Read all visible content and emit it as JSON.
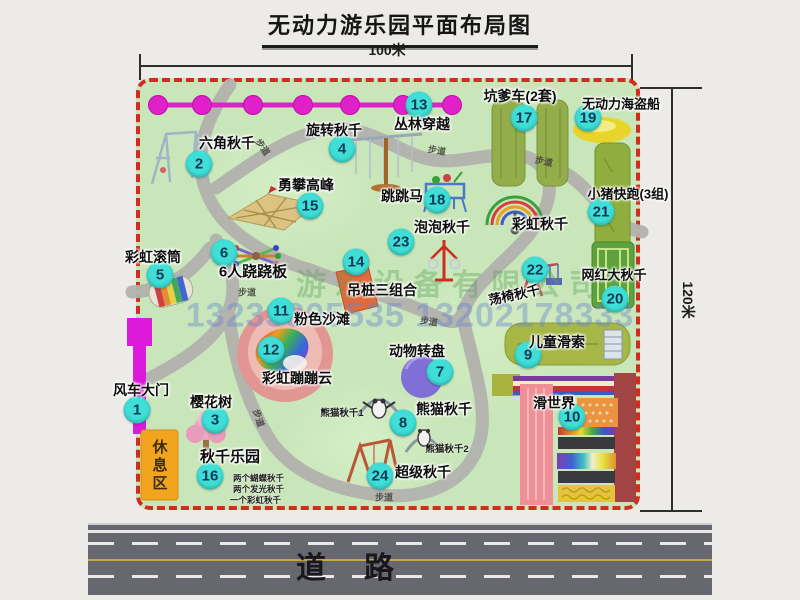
{
  "title": "无动力游乐园平面布局图",
  "dim_top_label": "100米",
  "dim_right_label": "120米",
  "road_label": "道路",
  "rest_area_label": "休息区",
  "walkway_text": "步道",
  "watermark_company": "游乐设备有限公司",
  "watermark_phone": "13233805535 13202178333",
  "colors": {
    "park_fill": "#c9e6ba",
    "boundary_red": "#d02d1e",
    "badge_cyan": "#3fded6",
    "zipline_magenta": "#e020c8",
    "road_gray": "#67676f",
    "rest_area_orange": "#f3a41f",
    "gate_magenta": "#dc1adc"
  },
  "attractions": [
    {
      "n": "1",
      "name": "风车大门",
      "bx": 137,
      "by": 410,
      "lx": 141,
      "ly": 390
    },
    {
      "n": "2",
      "name": "六角秋千",
      "bx": 199,
      "by": 164,
      "lx": 227,
      "ly": 143
    },
    {
      "n": "3",
      "name": "樱花树",
      "bx": 215,
      "by": 420,
      "lx": 211,
      "ly": 402
    },
    {
      "n": "4",
      "name": "旋转秋千",
      "bx": 342,
      "by": 149,
      "lx": 334,
      "ly": 130
    },
    {
      "n": "5",
      "name": "彩虹滚筒",
      "bx": 160,
      "by": 275,
      "lx": 153,
      "ly": 257
    },
    {
      "n": "6",
      "name": "6人跷跷板",
      "bx": 224,
      "by": 253,
      "lx": 253,
      "ly": 271,
      "fs": 15
    },
    {
      "n": "7",
      "name": "动物转盘",
      "bx": 440,
      "by": 372,
      "lx": 417,
      "ly": 351
    },
    {
      "n": "8",
      "name": "熊猫秋千",
      "bx": 403,
      "by": 423,
      "lx": 444,
      "ly": 409
    },
    {
      "n": "9",
      "name": "儿童滑索",
      "bx": 528,
      "by": 355,
      "lx": 557,
      "ly": 342
    },
    {
      "n": "10",
      "name": "滑世界",
      "bx": 572,
      "by": 417,
      "lx": 554,
      "ly": 403
    },
    {
      "n": "11",
      "name": "粉色沙滩",
      "bx": 281,
      "by": 311,
      "lx": 322,
      "ly": 319
    },
    {
      "n": "12",
      "name": "彩虹蹦蹦云",
      "bx": 271,
      "by": 350,
      "lx": 297,
      "ly": 378
    },
    {
      "n": "13",
      "name": "丛林穿越",
      "bx": 419,
      "by": 105,
      "lx": 422,
      "ly": 124
    },
    {
      "n": "14",
      "name": "吊桩三组合",
      "bx": 356,
      "by": 262,
      "lx": 382,
      "ly": 290
    },
    {
      "n": "15",
      "name": "勇攀高峰",
      "bx": 310,
      "by": 206,
      "lx": 306,
      "ly": 185
    },
    {
      "n": "16",
      "name": "秋千乐园",
      "bx": 210,
      "by": 476,
      "lx": 230,
      "ly": 456,
      "fs": 15
    },
    {
      "n": "17",
      "name": "坑爹车(2套)",
      "bx": 524,
      "by": 118,
      "lx": 520,
      "ly": 96
    },
    {
      "n": "18",
      "name": "跳跳马",
      "bx": 437,
      "by": 200,
      "lx": 402,
      "ly": 196
    },
    {
      "n": "19",
      "name": "无动力海盗船",
      "bx": 588,
      "by": 118,
      "lx": 621,
      "ly": 103,
      "fs": 13
    },
    {
      "n": "20",
      "name": "网红大秋千",
      "bx": 615,
      "by": 299,
      "lx": 614,
      "ly": 274,
      "fs": 13
    },
    {
      "n": "21",
      "name": "小猪快跑(3组)",
      "bx": 601,
      "by": 212,
      "lx": 628,
      "ly": 193,
      "fs": 13
    },
    {
      "n": "22",
      "name": "荡椅秋千",
      "bx": 535,
      "by": 270,
      "lx": 514,
      "ly": 294,
      "fs": 13,
      "rot": -12
    },
    {
      "n": "23",
      "name": "泡泡秋千",
      "bx": 401,
      "by": 242,
      "lx": 442,
      "ly": 227
    },
    {
      "n": "24",
      "name": "超级秋千",
      "bx": 380,
      "by": 476,
      "lx": 423,
      "ly": 472
    }
  ],
  "extra_labels": [
    {
      "text": "彩虹秋千",
      "x": 540,
      "y": 224
    }
  ],
  "sub_labels": [
    {
      "text": "熊猫秋千1",
      "x": 342,
      "y": 412
    },
    {
      "text": "熊猫秋千2",
      "x": 447,
      "y": 448
    }
  ],
  "swing_park_notes": [
    {
      "text": "两个蝴蝶秋千",
      "x": 233,
      "y": 478
    },
    {
      "text": "两个发光秋千",
      "x": 233,
      "y": 489
    },
    {
      "text": "一个彩虹秋千",
      "x": 230,
      "y": 500
    }
  ],
  "walkways": [
    {
      "x": 263,
      "y": 147,
      "r": 55
    },
    {
      "x": 437,
      "y": 150,
      "r": 10
    },
    {
      "x": 544,
      "y": 161,
      "r": 12
    },
    {
      "x": 247,
      "y": 292,
      "r": 0
    },
    {
      "x": 429,
      "y": 321,
      "r": 8
    },
    {
      "x": 259,
      "y": 418,
      "r": 72
    },
    {
      "x": 384,
      "y": 497,
      "r": 0
    }
  ]
}
